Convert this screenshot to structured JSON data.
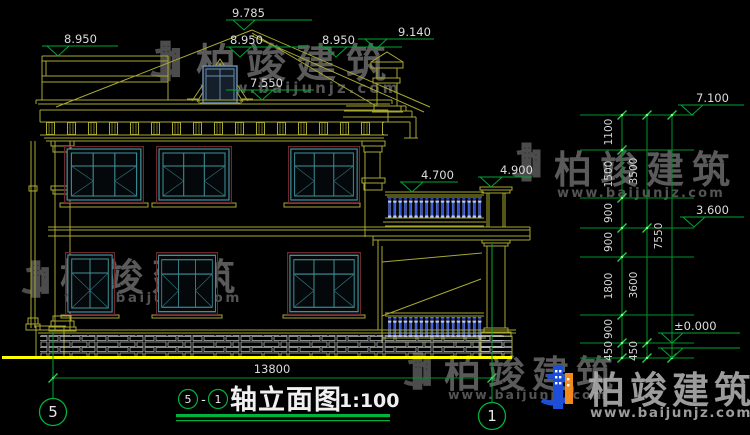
{
  "titlebar": {
    "axis_start": "5",
    "separator": "-",
    "axis_end": "1",
    "name": "轴立面图",
    "scale": "1:100"
  },
  "axes": {
    "left": "5",
    "right": "1"
  },
  "elevations": {
    "ridge": "9.785",
    "parapet_left": "8.950",
    "dormer_top": "8.950",
    "roof_right": "8.950",
    "chimney_top": "9.140",
    "eave": "7.550",
    "balcony_rail": "4.700",
    "balcony_pillar": "4.900",
    "right_roof": "7.100",
    "second_floor": "3.600",
    "zero": "±0.000"
  },
  "dimensions": {
    "total_width": "13800",
    "right_segments": [
      "1100",
      "1500",
      "900",
      "900",
      "1800",
      "900",
      "450"
    ],
    "right_subtotals": [
      "3500",
      "3600",
      "450"
    ],
    "right_total": "7550"
  },
  "watermark": {
    "brand": "柏竣建筑",
    "url": "www.baijunjz.com"
  }
}
